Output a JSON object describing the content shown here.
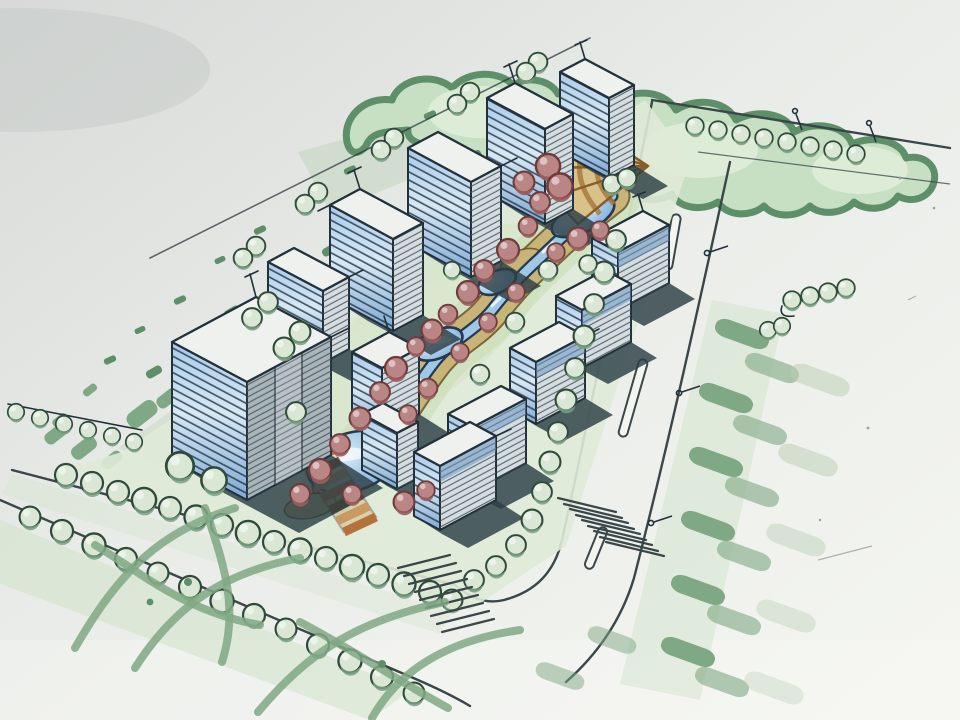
{
  "image": {
    "title": "Hand-drawn residential district master plan - aerial marker sketch",
    "medium": "marker and ink on paper, photographed"
  },
  "palette": {
    "paper": "#edf0ea",
    "paper_dim": "#dadedb",
    "ink": "#22303a",
    "ink_green": "#2f4a3a",
    "road_ink": "#3a4648",
    "foliage_dark": "#5d8f68",
    "foliage_mid": "#7fa884",
    "foliage_light": "#c7dfc3",
    "tree_fill": "#d9e7d4",
    "tree_shade": "#7aa183",
    "wash": "#dfead7",
    "wash_band": "#cfe2c8",
    "water": "#9ec7e8",
    "water_deep": "#6fa3cf",
    "water_ink": "#24384e",
    "bank": "#c9b478",
    "bank_ink": "#6b5a2e",
    "red_tree": "#b98585",
    "red_tree_dark": "#9a5f5f",
    "red_ink": "#6e3a3a",
    "wood": "#b5723b",
    "wood_dark": "#8a5526",
    "wood_light": "#c99a5f",
    "glass": "#8db9e2",
    "glass_light": "#d7e6f2",
    "glass_deep": "#5f8fc0",
    "facade": "#eef1ee",
    "facade_side": "#d5dde0",
    "shadow": "#2c3e45"
  },
  "scene": {
    "back_row_towers": 5,
    "middle_row_slabs": 4,
    "front_row_buildings": 4,
    "landmark": "tall glass tower at south-west corner",
    "water_feature": "winding stream with four ponds through central green spine",
    "plaza": "fan-shaped stepped plaza at stream head",
    "walkway": "timber boardwalk",
    "crosswalk_count": 2,
    "roads": [
      "tree-lined boulevard along top",
      "east road with dashed median",
      "south road with double tree rows"
    ],
    "planting": [
      "hedgerow canopy band along top",
      "street tree rows",
      "red accent trees along stream",
      "roadside hedge dashes on east verge",
      "grass scribbles at bottom left"
    ]
  }
}
